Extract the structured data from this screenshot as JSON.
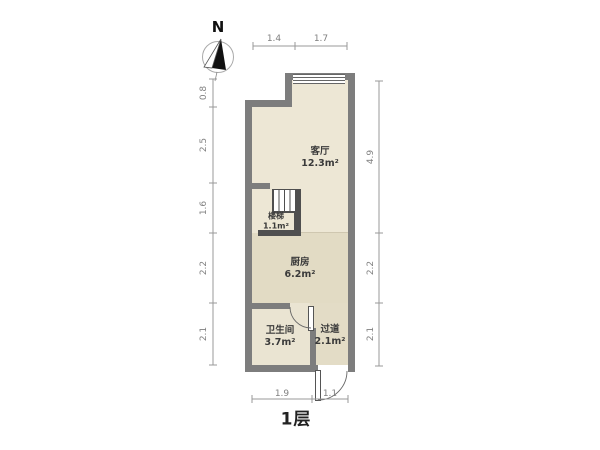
{
  "floor_plan": {
    "title": "1层",
    "compass_label": "N",
    "rooms": [
      {
        "name": "客厅",
        "area": "12.3m²"
      },
      {
        "name": "楼梯",
        "area": "1.1m²"
      },
      {
        "name": "厨房",
        "area": "6.2m²"
      },
      {
        "name": "卫生间",
        "area": "3.7m²"
      },
      {
        "name": "过道",
        "area": "2.1m²"
      }
    ],
    "dimensions": {
      "top": [
        "1.4",
        "1.7"
      ],
      "left": [
        "0.8",
        "2.5",
        "1.6",
        "2.2",
        "2.1"
      ],
      "right": [
        "4.9",
        "2.2",
        "2.1"
      ],
      "bottom": [
        "1.9",
        "1.1"
      ]
    },
    "colors": {
      "wall": "#7d7d7d",
      "wall_dark": "#4f4f4f",
      "floor_living": "#ede7d5",
      "floor_kitchen": "#e2dbc4",
      "floor_bath": "#eae4d2",
      "floor_hall": "#e3dcc6",
      "dimension_text": "#808080",
      "room_text": "#3a3a3a"
    }
  }
}
